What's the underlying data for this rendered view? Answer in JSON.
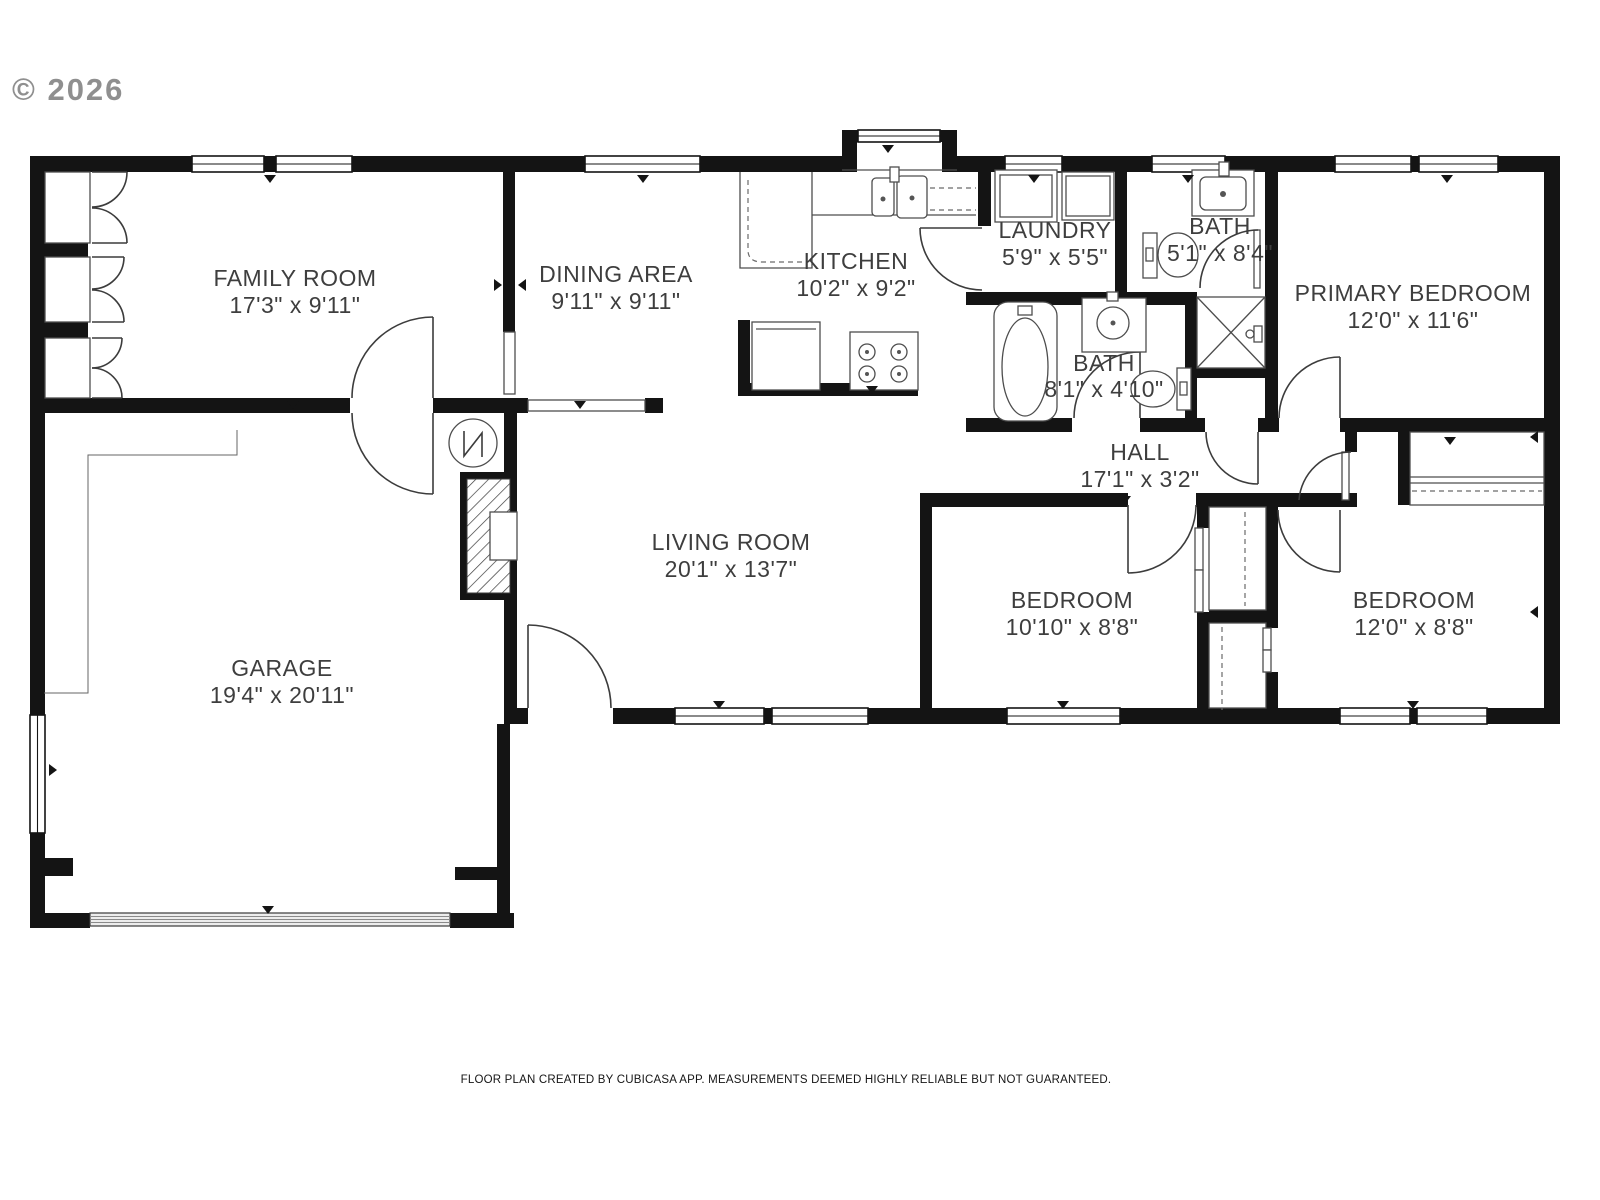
{
  "watermark": "© 2026",
  "footer": "FLOOR PLAN CREATED BY CUBICASA APP. MEASUREMENTS DEEMED HIGHLY RELIABLE BUT NOT GUARANTEED.",
  "colors": {
    "wall": "#141414",
    "label": "#3e3e3e",
    "watermark": "#8f8f8f",
    "background": "#ffffff"
  },
  "rooms": [
    {
      "name": "FAMILY ROOM",
      "dims": "17'3\" x 9'11\""
    },
    {
      "name": "DINING AREA",
      "dims": "9'11\" x 9'11\""
    },
    {
      "name": "KITCHEN",
      "dims": "10'2\" x 9'2\""
    },
    {
      "name": "LAUNDRY",
      "dims": "5'9\" x 5'5\""
    },
    {
      "name": "BATH",
      "dims": "5'1\" x 8'4\""
    },
    {
      "name": "PRIMARY BEDROOM",
      "dims": "12'0\" x 11'6\""
    },
    {
      "name": "BATH",
      "dims": "8'1\" x 4'10\""
    },
    {
      "name": "HALL",
      "dims": "17'1\" x 3'2\""
    },
    {
      "name": "LIVING ROOM",
      "dims": "20'1\" x 13'7\""
    },
    {
      "name": "GARAGE",
      "dims": "19'4\" x 20'11\""
    },
    {
      "name": "BEDROOM",
      "dims": "10'10\" x 8'8\""
    },
    {
      "name": "BEDROOM",
      "dims": "12'0\" x 8'8\""
    }
  ]
}
